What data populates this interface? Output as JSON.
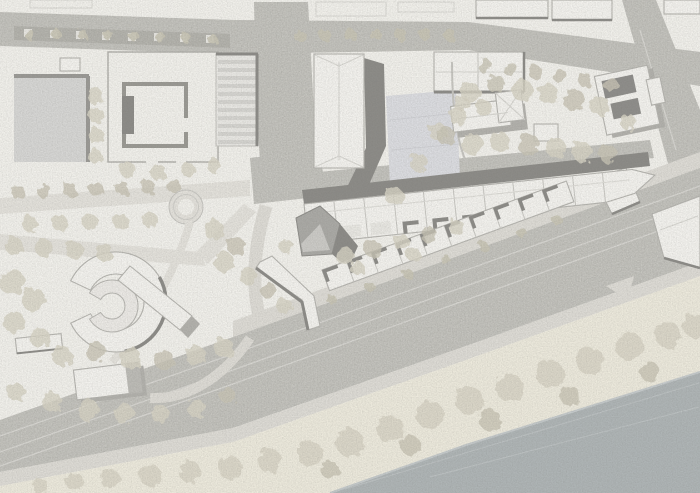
{
  "document": {
    "kind": "architectural site plan",
    "style": "grayscale masterplan drawing, aerial top view",
    "visible_text": "none"
  },
  "palette": {
    "paper": "#f2f1ec",
    "road": "#cbcac5",
    "road_dark_strip": "#bab9b3",
    "sidewalk": "#dedcd6",
    "path": "#e4e2dc",
    "building": "#f4f3ef",
    "building_stroke": "#b6b5b0",
    "building_dark": "#abaaa6",
    "roof_dark": "#8f8e8b",
    "shadow": "#8d8c88",
    "shadow_soft": "#b3b2ad",
    "plaza": "#d7d7d5",
    "court": "#dcdde1",
    "tree": "#d7d3c5",
    "tree_dark": "#c8c4b5",
    "shore_band": "#edeadd",
    "river": "#afb5b6",
    "lane": "#dad9d5",
    "ridge": "#d8d7d2",
    "stripe": "#d6d5d1"
  },
  "features": [
    {
      "id": "river",
      "label": "river at lower right"
    },
    {
      "id": "riverside-tree-band",
      "label": "cream promenade strip with tree canopies along the river"
    },
    {
      "id": "embankment-road",
      "label": "wide diagonal embankment road with lane lines"
    },
    {
      "id": "site-upper-terrace-row",
      "label": "upper terraced housing row along the street with dark shadow band"
    },
    {
      "id": "site-lower-sawtooth-row",
      "label": "lower sawtooth terraced housing row facing the road"
    },
    {
      "id": "corner-dark-building",
      "label": "dark faceted corner building at site entry"
    },
    {
      "id": "courtyard-school-block",
      "label": "courtyard building block, top left"
    },
    {
      "id": "striped-roof-building",
      "label": "long striped-roof building"
    },
    {
      "id": "gray-plaza",
      "label": "gray paved court, far top left"
    },
    {
      "id": "slab-building-shadow",
      "label": "tall slab building casting long dark shadow"
    },
    {
      "id": "blue-gray-court",
      "label": "light blue-gray paved schoolyard"
    },
    {
      "id": "park-allees",
      "label": "park with twin tree-lined diagonal allees"
    },
    {
      "id": "roundabout-circle",
      "label": "circular path node in park"
    },
    {
      "id": "crescent-structures",
      "label": "crescent shaped structures with diagonal bar, west park"
    },
    {
      "id": "flat-pavilion",
      "label": "flat pavilion near riverside park"
    },
    {
      "id": "ne-park-gabled-building",
      "label": "gabled building in north-east park"
    },
    {
      "id": "dark-roof-villa",
      "label": "villa with dark roof panels, right edge"
    },
    {
      "id": "branch-road",
      "label": "road branching to the top right corner"
    },
    {
      "id": "fork-wedge-buildings",
      "label": "wedge buildings in the road fork"
    }
  ]
}
